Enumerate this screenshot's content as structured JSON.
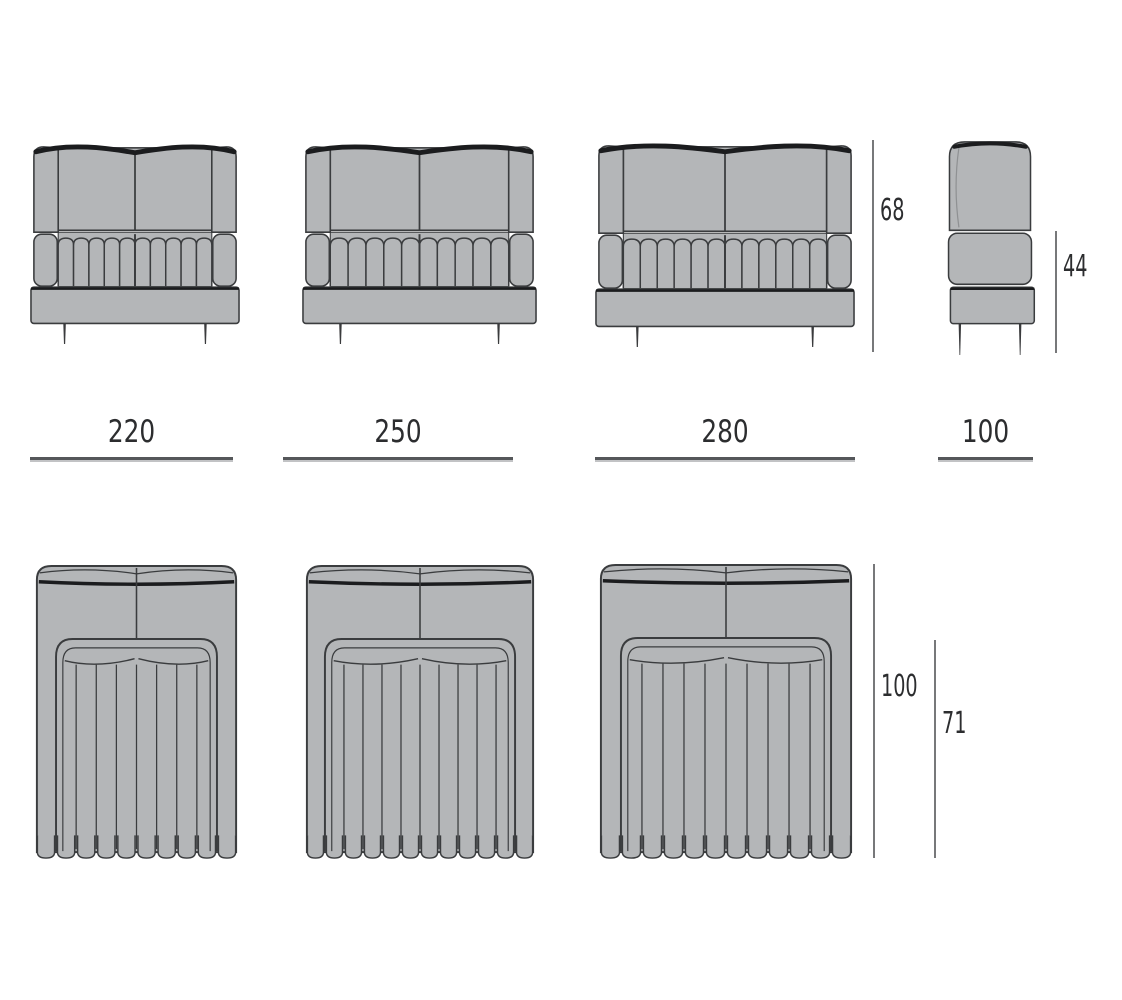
{
  "colors": {
    "background": "#ffffff",
    "body": "#b4b6b8",
    "line": "#3a3c3e",
    "dark": "#1b1c1e",
    "soft": "#8f9193",
    "leg": "#3a3b3d",
    "dim_line": "#77787a",
    "label": "#2c2d2f"
  },
  "dimensions": {
    "widths": [
      "220",
      "250",
      "280",
      "100"
    ],
    "overall_height": "68",
    "seat_height": "44",
    "overall_depth": "100",
    "seat_depth": "71"
  }
}
